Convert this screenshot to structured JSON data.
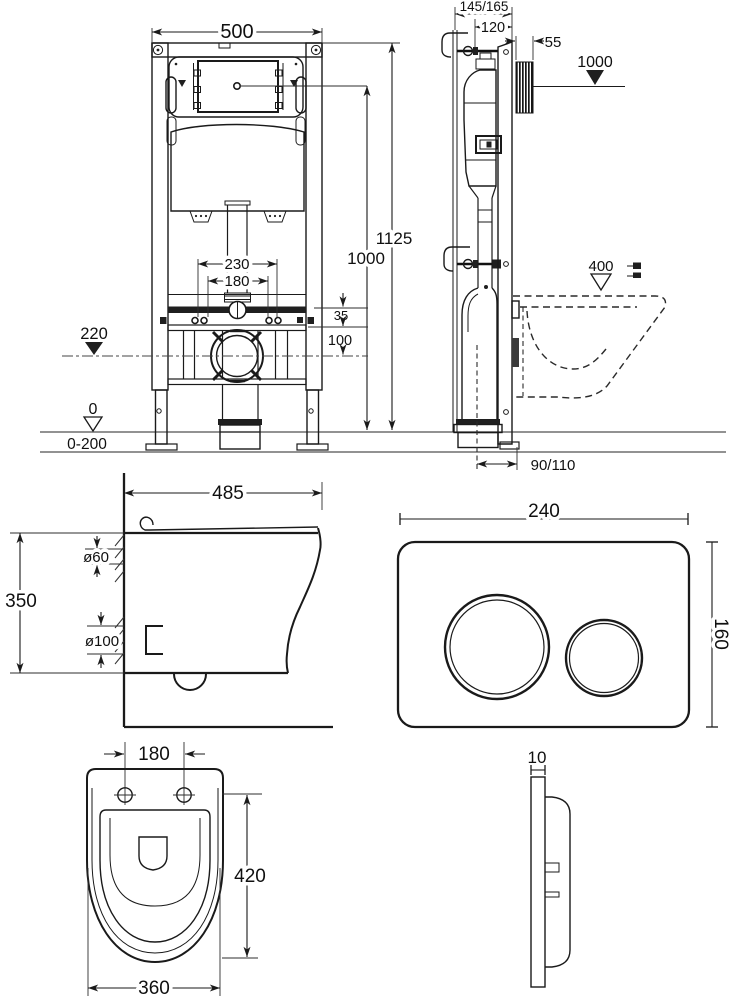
{
  "page": {
    "background": "#ffffff",
    "line_color": "#1a1a1a",
    "floor_line_color": "#6f6f6f",
    "description": "Dimensional installation drawing: concealed cistern frame, wall-hung bowl and flush plate"
  },
  "views": {
    "frame_front": {
      "label": "installation-frame-front-view",
      "dims": {
        "width": "500",
        "total_height": "1125",
        "actuator_height": "1000",
        "bolt_spacing_outer": "230",
        "bolt_spacing_inner": "180",
        "water_inlet_height": "220",
        "rail_offset": "35",
        "drain_drop": "100",
        "floor_level": "0",
        "adjust_range": "0-200"
      }
    },
    "frame_side": {
      "label": "installation-frame-side-view",
      "dims": {
        "total_depth": "145/165",
        "frame_depth": "120",
        "plate_recess": "55",
        "actuator_height": "1000",
        "bowl_rim_height": "400",
        "drain_offset": "90/110"
      }
    },
    "bowl_side": {
      "label": "bowl-side-view",
      "dims": {
        "depth": "485",
        "height": "350",
        "inlet_diameter": "ø60",
        "outlet_diameter": "ø100"
      }
    },
    "plate_front": {
      "label": "flush-plate-front-view",
      "dims": {
        "width": "240",
        "height": "160"
      }
    },
    "bowl_top": {
      "label": "bowl-top-view",
      "dims": {
        "bolt_spacing": "180",
        "depth": "420",
        "width": "360"
      }
    },
    "plate_side": {
      "label": "flush-plate-side-view",
      "dims": {
        "thickness": "10"
      }
    }
  }
}
